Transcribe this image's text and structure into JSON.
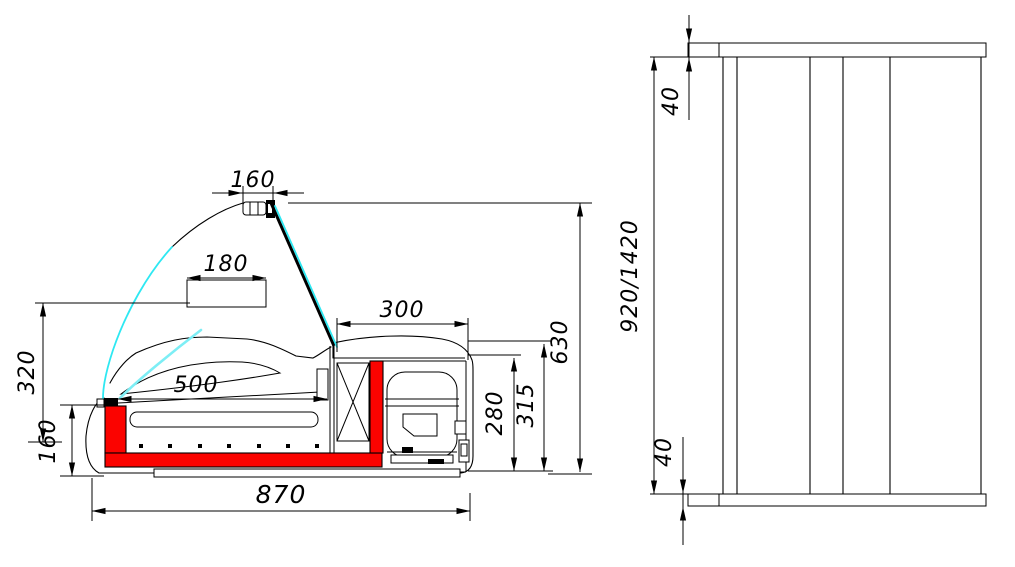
{
  "drawing": {
    "type": "technical-drawing",
    "units": "mm",
    "colors": {
      "background": "#ffffff",
      "line": "#000000",
      "insulation_red": "#fb0300",
      "glass_cyan": "#2ee8f2"
    },
    "views": {
      "side_section": {
        "dimensions": {
          "lamp_width": "160",
          "shelf_width": "180",
          "deck_length": "500",
          "machine_width": "300",
          "glass_front_height": "320",
          "front_base_height": "160",
          "machine_height": "280",
          "worktop_height": "315",
          "overall_height": "630",
          "overall_depth": "870"
        }
      },
      "front": {
        "dimensions": {
          "top_panel": "40",
          "body_height": "920/1420",
          "bottom_panel": "40"
        }
      }
    }
  }
}
